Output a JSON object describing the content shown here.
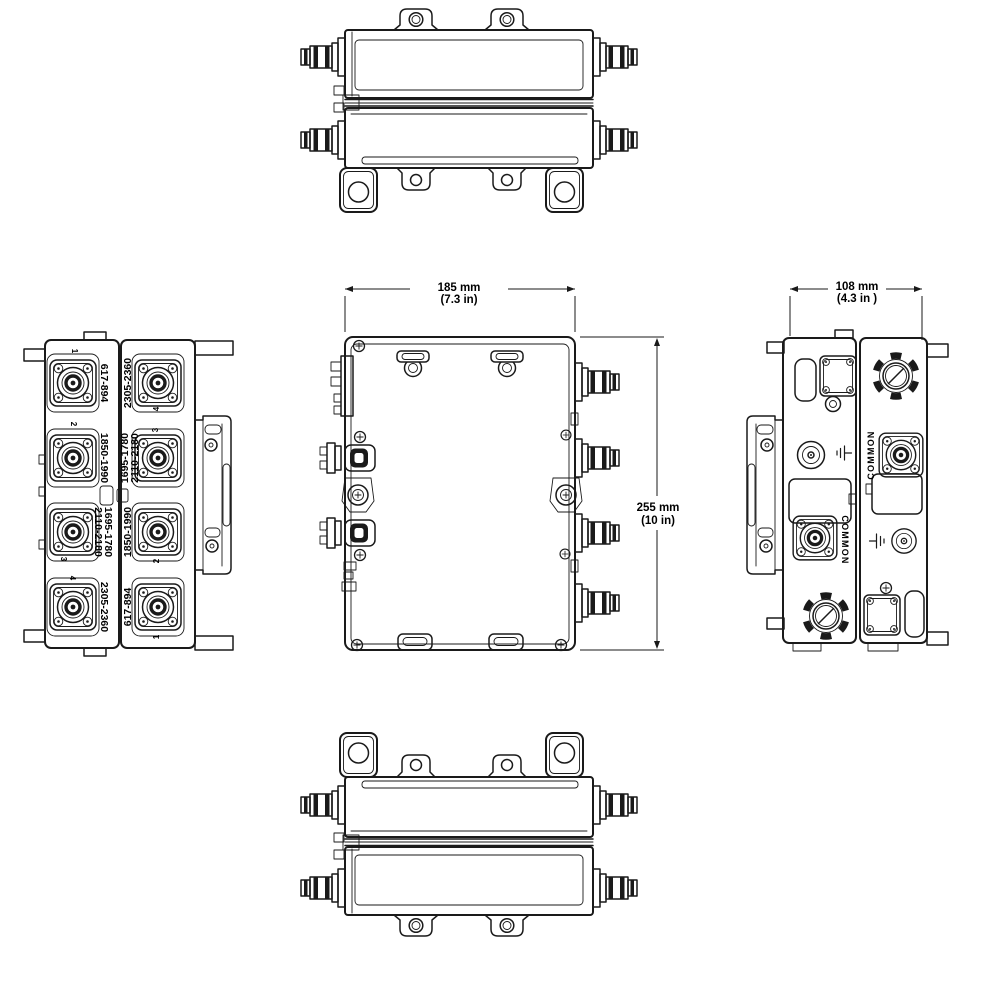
{
  "drawing": {
    "type": "mechanical-outline-drawing",
    "colors": {
      "line": "#1a1a1a",
      "background": "#ffffff"
    }
  },
  "dimensions": {
    "front_width": {
      "line1": "185 mm",
      "line2": "(7.3 in)"
    },
    "front_height": {
      "line1": "255 mm",
      "line2": "(10 in)"
    },
    "side_depth": {
      "line1": "108 mm",
      "line2": "(4.3 in )"
    }
  },
  "left_view": {
    "col_a": [
      {
        "num": "1",
        "freq1": "617-894"
      },
      {
        "num": "2",
        "freq1": "1850-1990"
      },
      {
        "num": "3",
        "freq1": "1695-1780",
        "freq2": "2110-2180"
      },
      {
        "num": "4",
        "freq1": "2305-2360"
      }
    ],
    "col_b": [
      {
        "num": "4",
        "freq1": "2305-2360"
      },
      {
        "num": "3",
        "freq1": "1695-1780",
        "freq2": "2110-2180"
      },
      {
        "num": "2",
        "freq1": "1850-1990"
      },
      {
        "num": "1",
        "freq1": "617-894"
      }
    ]
  },
  "right_view": {
    "common_1": "COMMON",
    "common_2": "COMMON"
  }
}
